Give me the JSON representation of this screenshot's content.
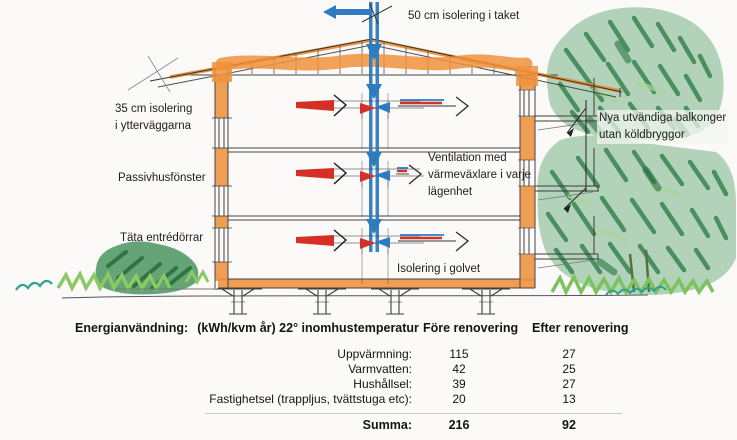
{
  "diagram": {
    "labels": {
      "roof_insulation": "50 cm isolering i taket",
      "wall_insulation": [
        "35 cm isolering",
        "i ytterväggarna"
      ],
      "passive_windows": "Passivhusfönster",
      "entry_doors": "Täta entrédörrar",
      "ventilation": [
        "Ventilation med",
        "värmeväxlare i varje",
        "lägenhet"
      ],
      "floor_insulation": "Isolering i golvet",
      "balconies": [
        "Nya utvändiga balkonger",
        "utan köldbryggor"
      ]
    },
    "colors": {
      "insulation_orange": "#ef9443",
      "ventilation_blue": "#2e7cc0",
      "warm_air_red": "#d63026",
      "vegetation_green": "#3e8f55"
    }
  },
  "table": {
    "title": "Energianvändning:",
    "title_units": "(kWh/kvm år) 22° inomhustemperatur",
    "columns": {
      "before": "Före renovering",
      "after": "Efter renovering"
    },
    "rows": [
      {
        "label": "Uppvärmning:",
        "before": "115",
        "after": "27"
      },
      {
        "label": "Varmvatten:",
        "before": "42",
        "after": "25"
      },
      {
        "label": "Hushållsel:",
        "before": "39",
        "after": "27"
      },
      {
        "label": "Fastighetsel (trappljus, tvättstuga etc):",
        "before": "20",
        "after": "13"
      }
    ],
    "summary": {
      "label": "Summa:",
      "before": "216",
      "after": "92"
    }
  }
}
